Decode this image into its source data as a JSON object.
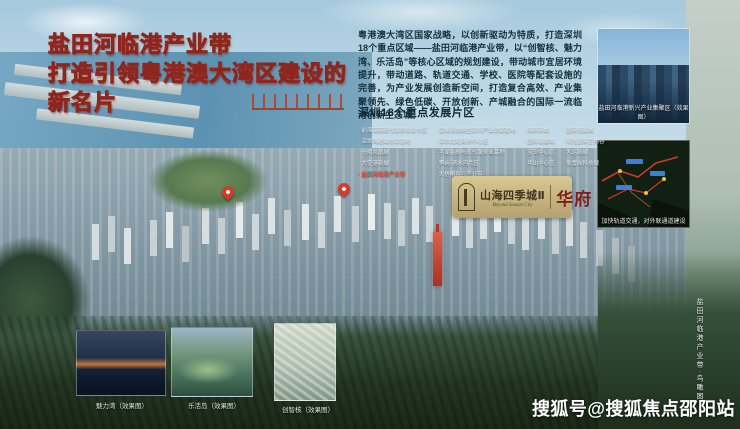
{
  "headline": {
    "line1": "盐田河临港产业带",
    "line2": "打造引领粤港澳大湾区建设的",
    "line3": "新名片"
  },
  "intro": {
    "text": "粤港澳大湾区国家战略，以创新驱动为特质，打造深圳18个重点区域——盐田河临港产业带，以“创智核、魅力湾、乐活岛”等核心区域的规划建设，带动城市宜居环境提升，带动道路、轨道交通、学校、医院等配套设施的完善，为产业发展创造新空间，打造复合高效、产业集聚领先、绿色低碳、开放创新、产城融合的国际一流临港创新生态城。"
  },
  "districts": {
    "heading": "深圳18个重点发展片区",
    "columns": [
      [
        "前海深港现代服务业合作区",
        "深圳湾超级总部基地",
        "光明凤凰城",
        "大空港新城",
        "盐田河临港产业带"
      ],
      [
        "留仙洞战略性新兴产业总部基地",
        "深圳北站商务中心区",
        "平湖金融与现代服务业基地",
        "笋岗-清水河片区",
        "大梧桐新兴产业带"
      ],
      [
        "海洋新城",
        "国际会展城",
        "宝安中心区",
        "坪山中心区"
      ],
      [
        "国际低碳城",
        "坝光国际生物谷",
        "大运新城",
        "坂雪岗科技城"
      ]
    ],
    "highlighted_item": "盐田河临港产业带"
  },
  "logo": {
    "emblem_icon": "tower-arch-emblem-icon",
    "name_cn": "山海四季城Ⅱ",
    "name_en": "Beyond Season City",
    "seal": "华府"
  },
  "photos": {
    "right_top_caption": "盐田河临港新兴产业集聚区（效果图）",
    "right_bottom_caption": "加快轨道交通，对外联通道建设",
    "bottom_captions": [
      "魅力湾（效果图）",
      "乐活岛（效果图）",
      "创智核（效果图）"
    ]
  },
  "side_caption": "盐田河临港产业带·鸟瞰图",
  "watermark": "搜狐号@搜狐焦点邵阳站",
  "colors": {
    "headline_fill": "#ffffff",
    "headline_stroke": "#8e261d",
    "intro_text": "#14303b",
    "district_highlight": "#ff4a33",
    "logo_gold": "#c9b87f",
    "logo_text": "#44341f",
    "seal_red": "#7e1f1c",
    "pin_red": "#d63a2a",
    "watermark_text": "#ffffff"
  }
}
